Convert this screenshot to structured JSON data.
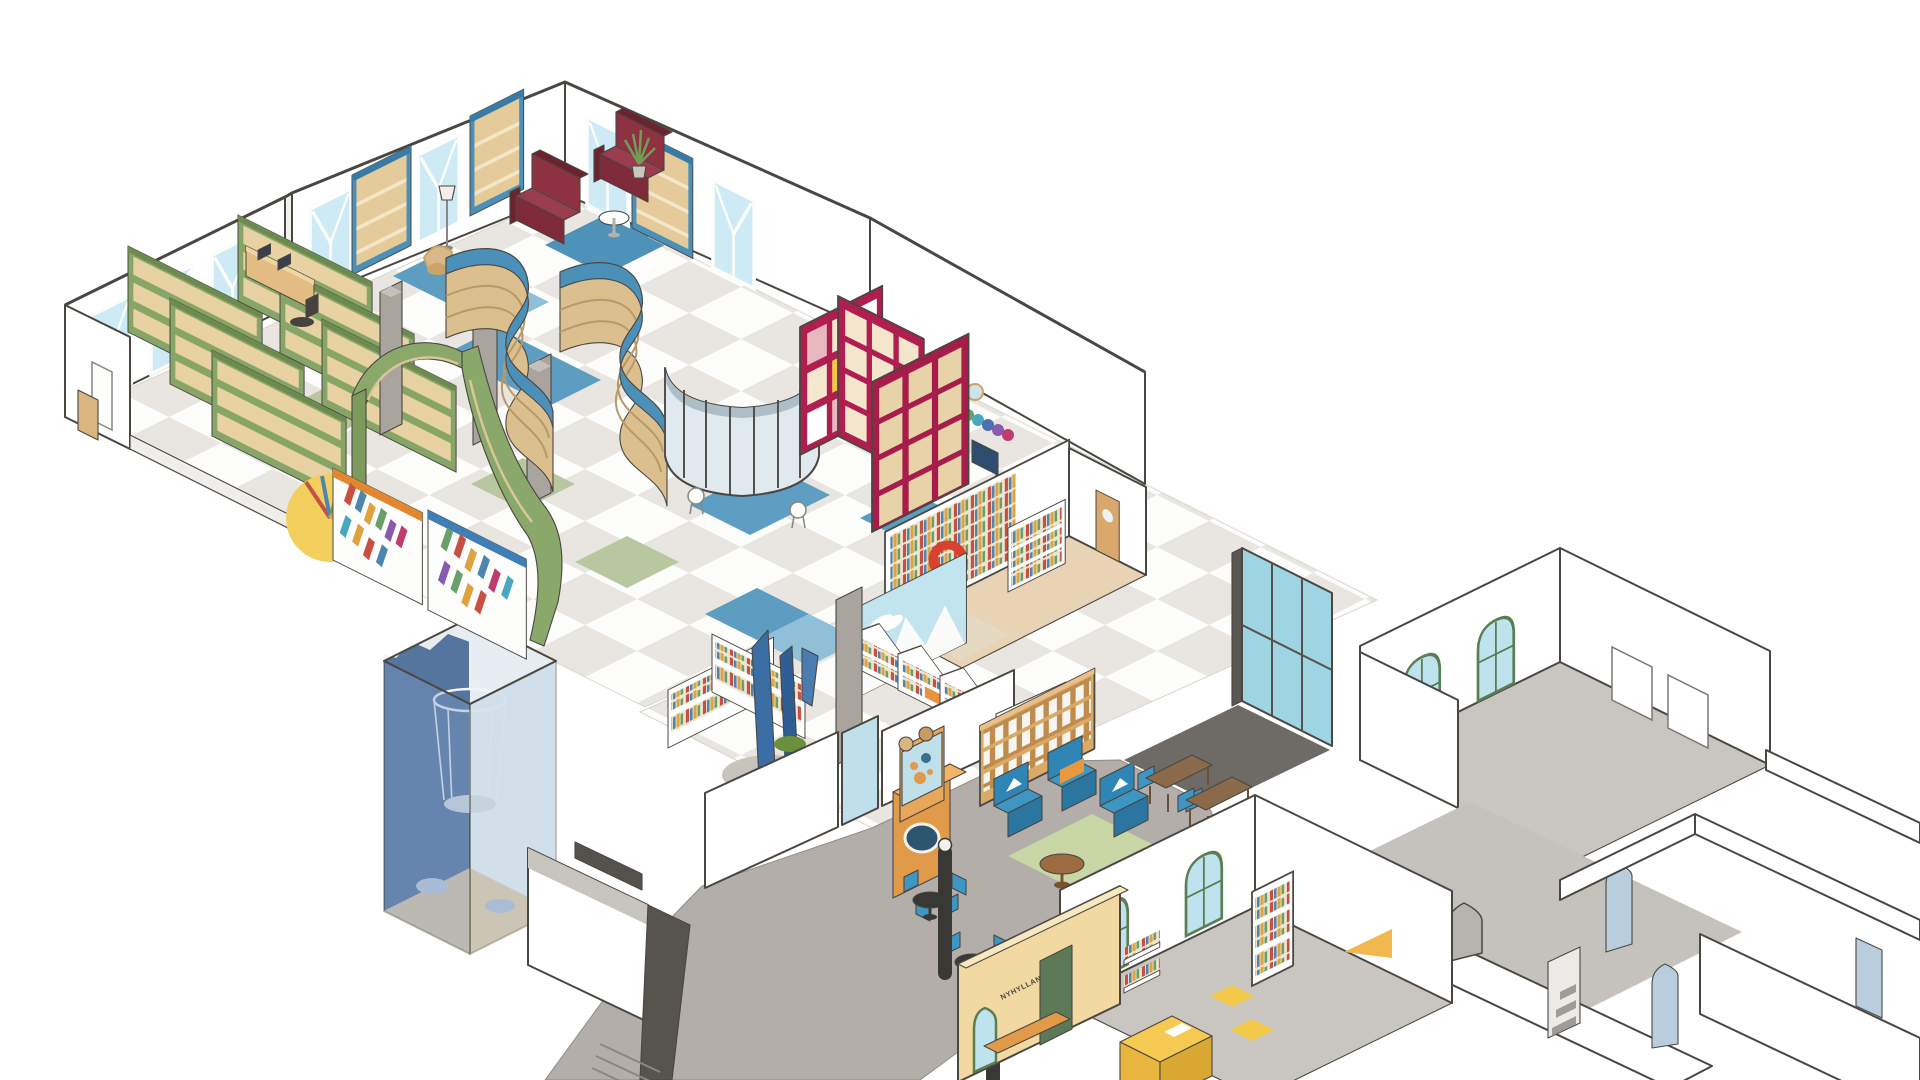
{
  "labels": {
    "magazines": "TIDSKRIFTER",
    "new_shelf": "NYHYLLAN"
  },
  "palette": {
    "background": "#ffffff",
    "outline": "#4a4743",
    "floor_tile_light": "#fdfdfc",
    "floor_tile_gray": "#e9e6e2",
    "floor_cafe_gray": "#b3aeaa",
    "floor_room_gray": "#c9c5c0",
    "window_glass": "#cdeaf5",
    "glass_teal": "#9fd4e2",
    "shelf_green": "#86a566",
    "shelf_blue": "#4a90b8",
    "shelf_crimson": "#b01e4f",
    "sofa_dark_red": "#8e3242",
    "wood_tan": "#d9a967",
    "chair_blue": "#3e96c4",
    "kiosk_orange": "#e09a4a",
    "wall_cream_yellow": "#f2d9a2",
    "desk_yellow": "#f6c952",
    "slide_red": "#d7422f",
    "rug_green": "#c9d6a6",
    "rug_blue": "#4e92ba",
    "cube_wall_blue": "#55759e",
    "sign_text_navy": "#1e3a5f"
  }
}
